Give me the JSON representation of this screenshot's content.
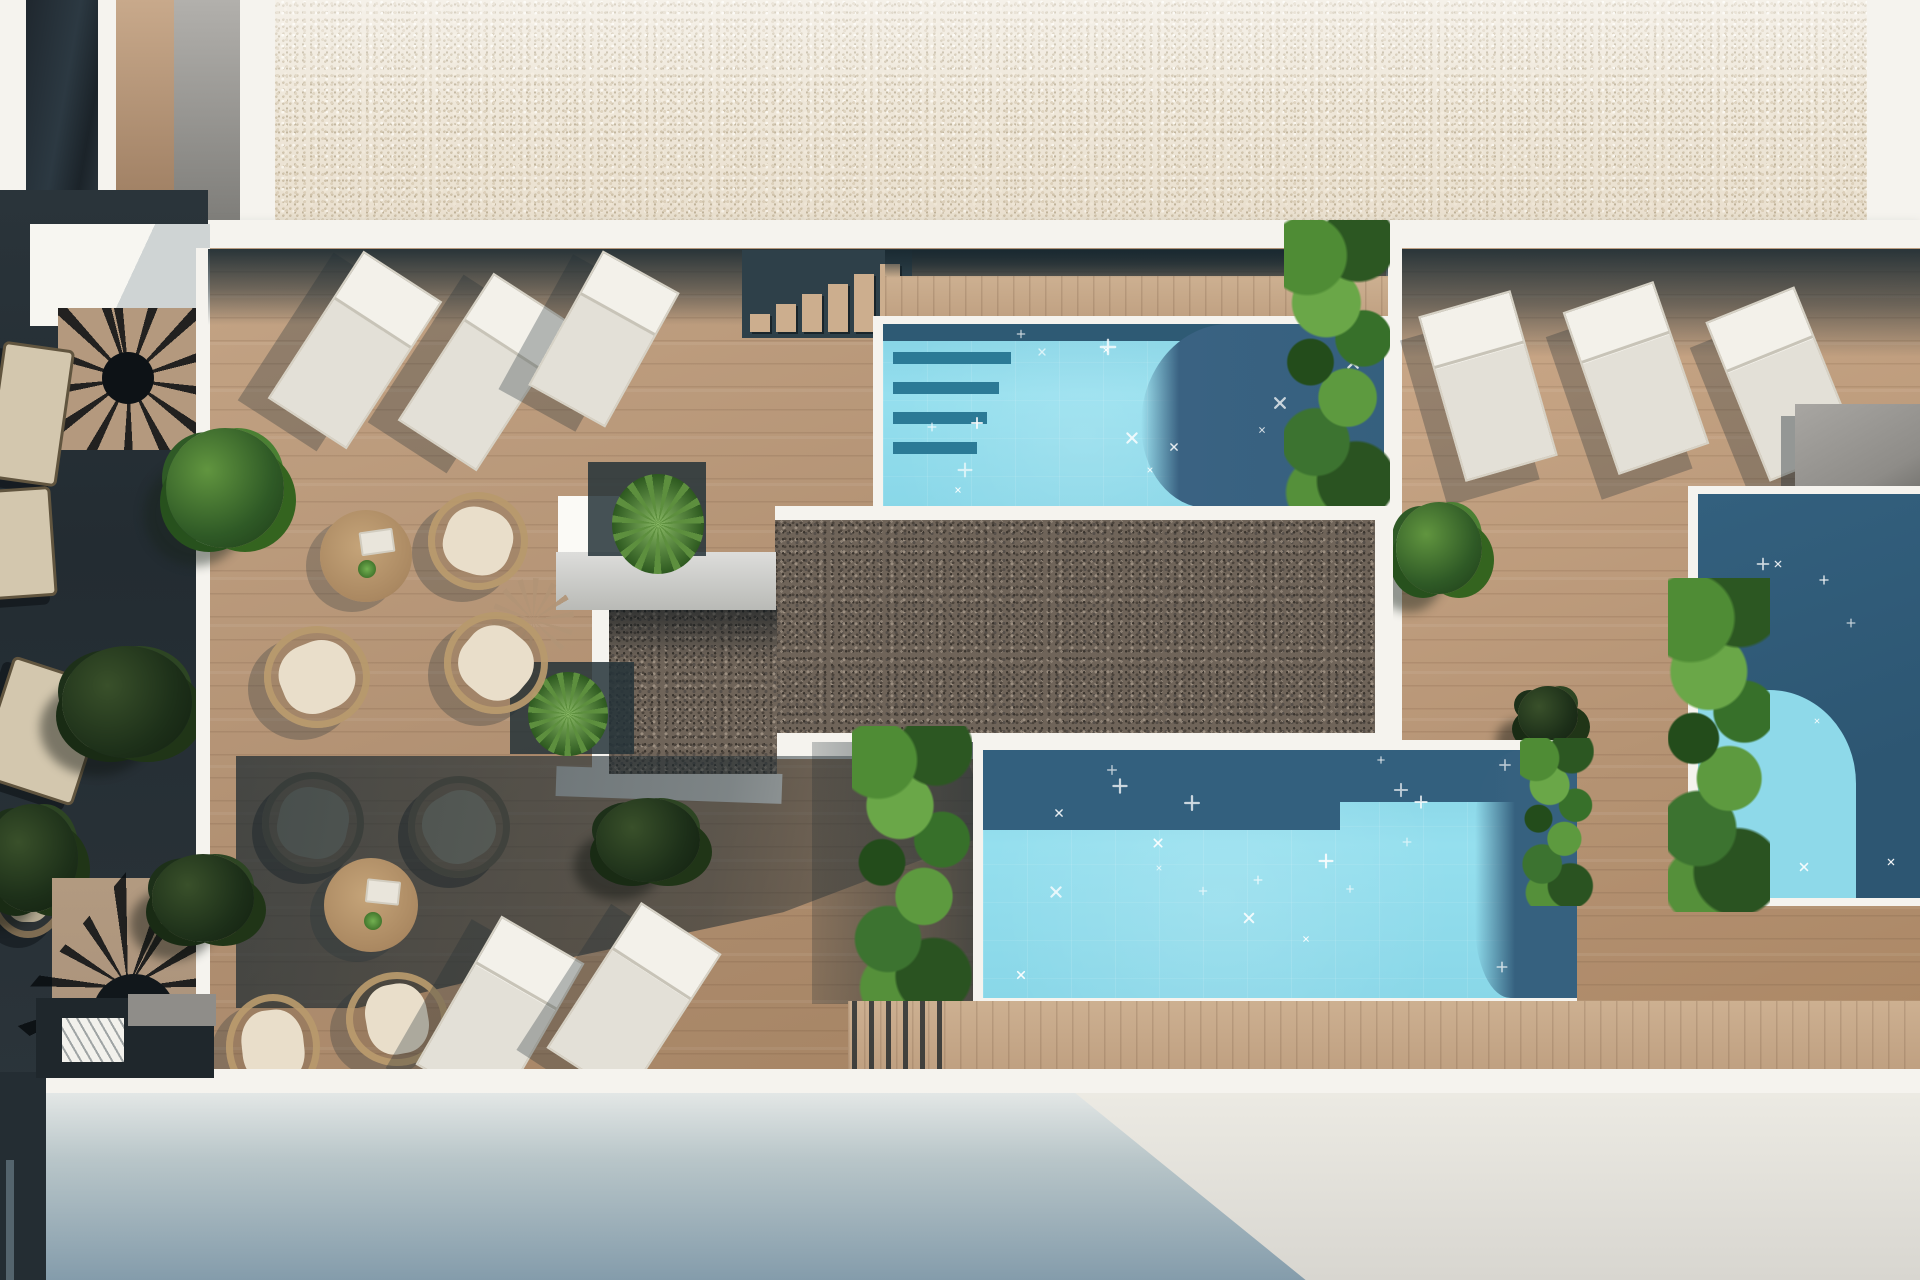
{
  "image": {
    "title": "Top-down architectural rendering of a rooftop pool terrace",
    "type": "3d-render-aerial-view",
    "visible_text": ""
  },
  "palette": {
    "paper": "#f5f3ee",
    "gravel-beige": "#ebe3d4",
    "gravel-dark": "#6f6459",
    "deck-wood": "#b69575",
    "deck-light": "#c9ab8c",
    "shadow-teal": "#2f4149",
    "terrace-dark": "#262f35",
    "aqua": "#8ed9e9",
    "pool-shadow": "#36617f",
    "pool-dark": "#2e5a74",
    "leaf": "#3a6b2e",
    "cushion": "#e9deca",
    "rattan": "#ba9b6e",
    "facade-top": "#e3e7e6",
    "facade-blue": "#849cab",
    "facade-lit": "#e9e7e0"
  },
  "scene": {
    "areas": [
      "upper gravel roof",
      "left shaded terrace",
      "main wooden deck",
      "central dark-gravel bed",
      "top pool",
      "bottom pool",
      "right pool",
      "lower facade wall"
    ],
    "counts": {
      "pools": 3,
      "sun_loungers": 8,
      "round_tables": 2,
      "rattan_chairs": 9,
      "benches": 3,
      "spiral_staircases": 2,
      "step_staircases": 1,
      "plant_clusters": 15,
      "gravel_areas": 3
    }
  },
  "pools": [
    {
      "name": "top-pool",
      "sparkles": 14
    },
    {
      "name": "bottom-pool",
      "sparkles": 20
    },
    {
      "name": "right-pool",
      "sparkles": 9
    }
  ]
}
